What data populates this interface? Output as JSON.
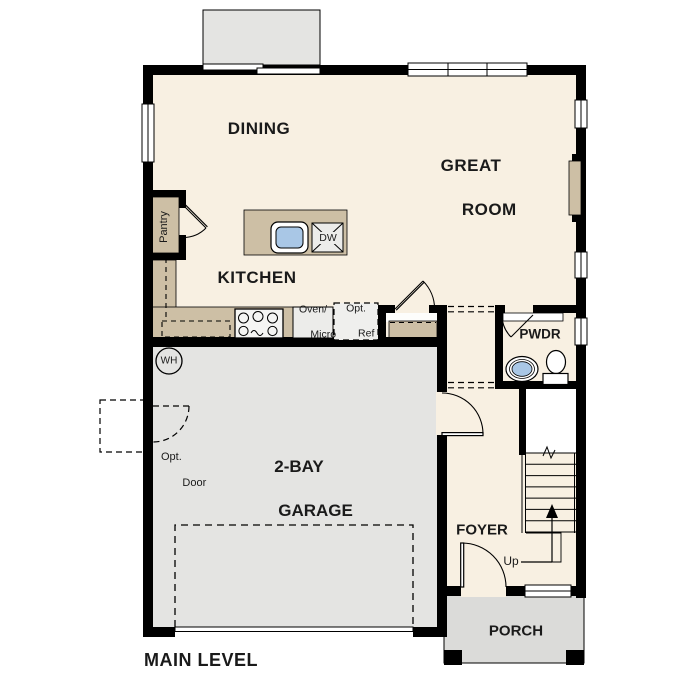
{
  "title": {
    "main_level": "MAIN LEVEL"
  },
  "rooms": {
    "dining": "DINING",
    "great_room": [
      "GREAT",
      "ROOM"
    ],
    "kitchen": "KITCHEN",
    "powder": "PWDR",
    "foyer": "FOYER",
    "porch": "PORCH",
    "garage": [
      "2-BAY",
      "GARAGE"
    ],
    "pantry": "Pantry"
  },
  "annotations": {
    "up": "Up",
    "opt_door": [
      "Opt.",
      "Door"
    ],
    "oven_micro": [
      "Oven/",
      "Micro"
    ],
    "opt_ref": [
      "Opt.",
      "Ref"
    ],
    "dishwasher": "DW",
    "water_heater": "WH"
  },
  "colors": {
    "floor": "#f8f0e2",
    "counter": "#cdbfa5",
    "garage_floor": "#e4e4e2",
    "porch_floor": "#dbdbd9",
    "patio": "#e4e4e2",
    "fixture_water": "#a9c7e6",
    "wall": "#000000",
    "appliance_gray": "#ececea"
  }
}
